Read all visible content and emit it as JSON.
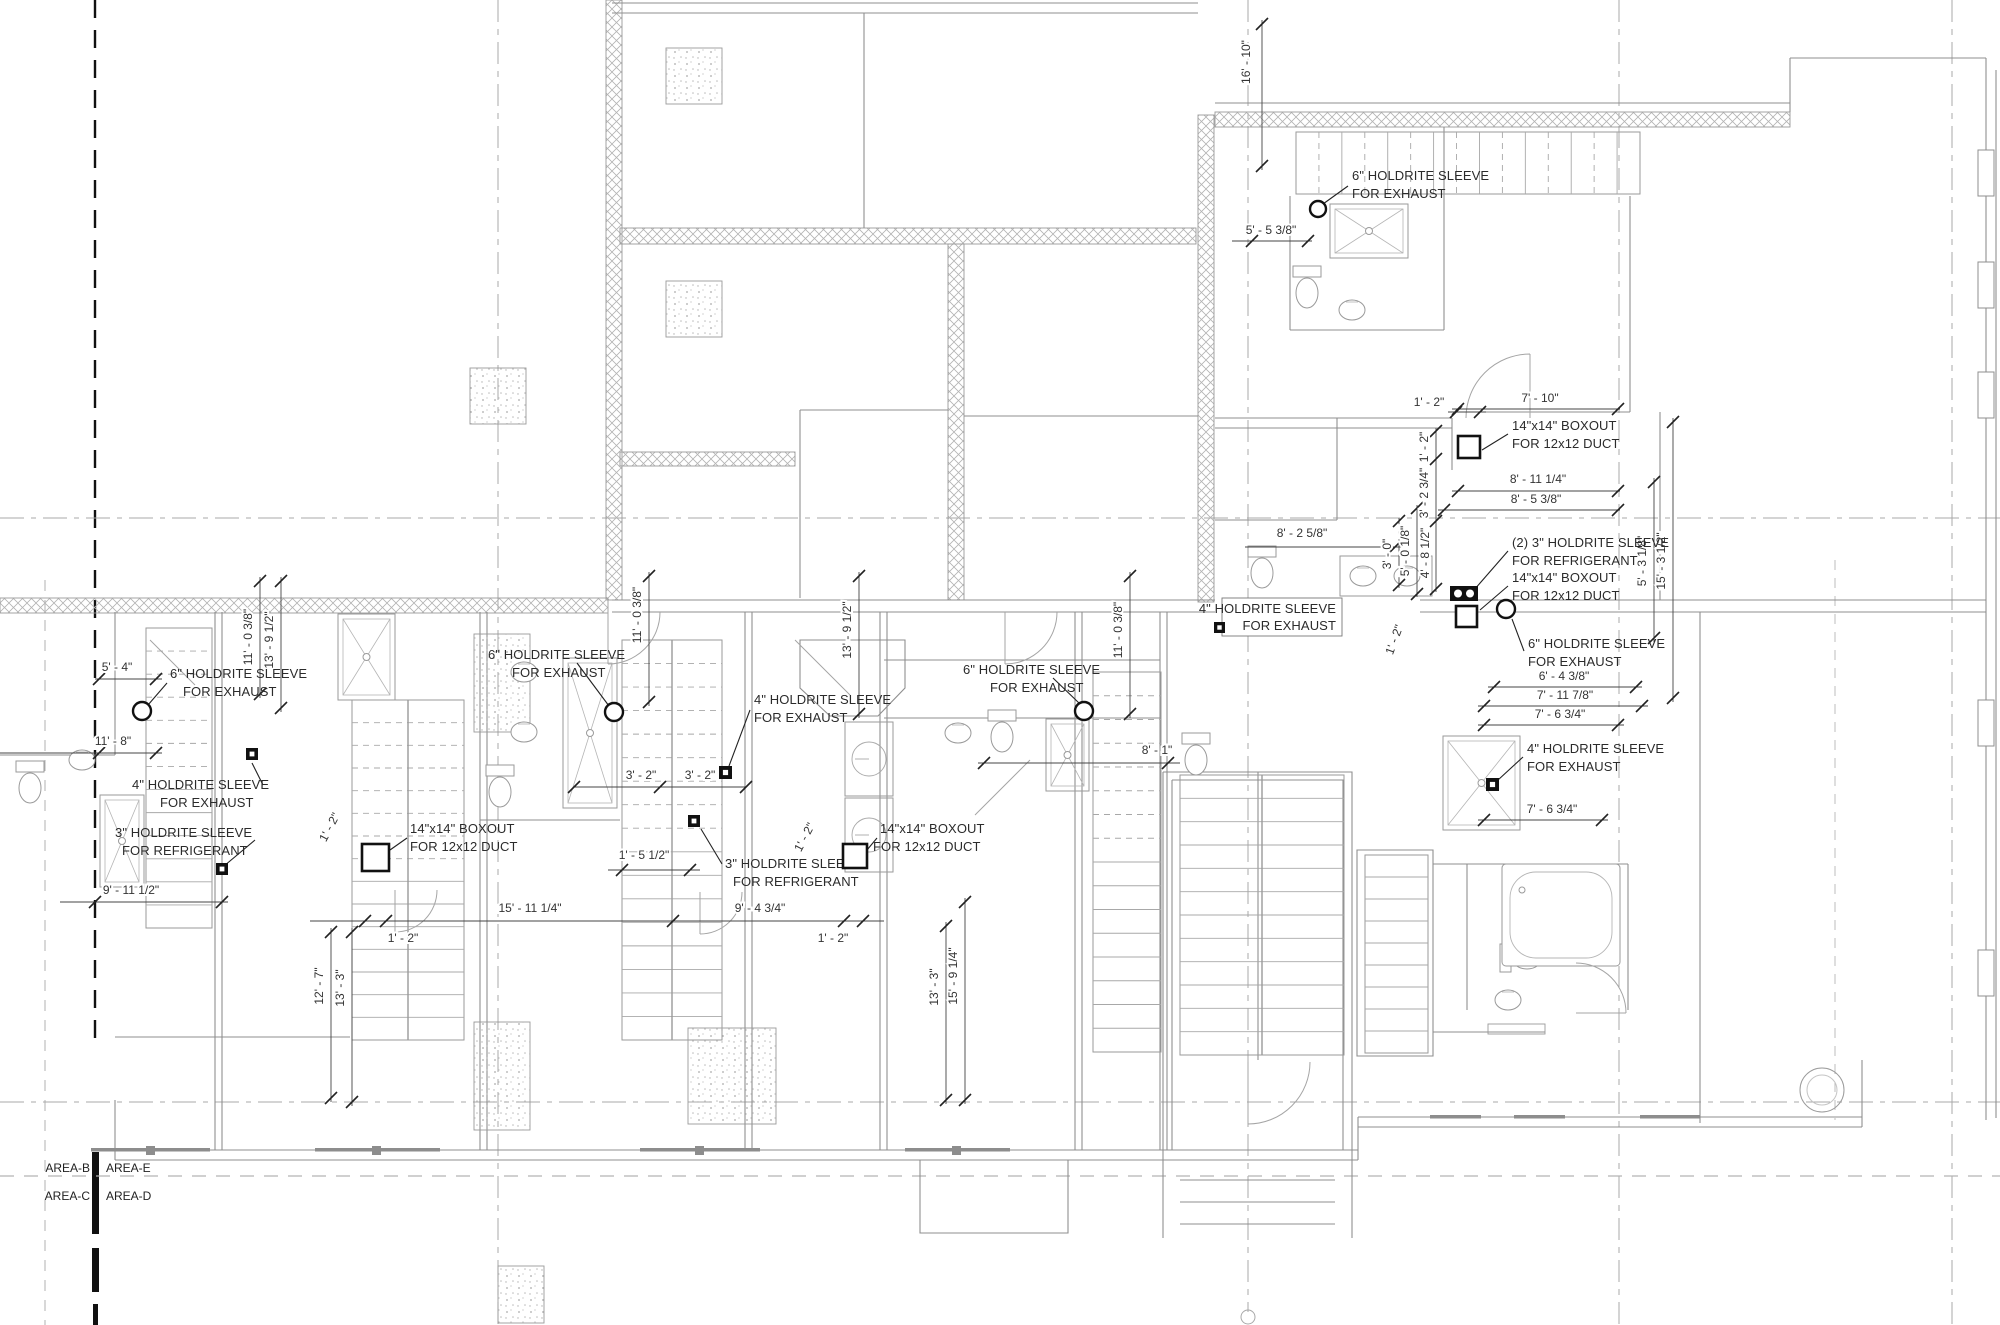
{
  "drawing": {
    "type": "architectural floor plan - mechanical sleeve and boxout plan",
    "area_labels": {
      "b": "AREA-B",
      "e": "AREA-E",
      "c": "AREA-C",
      "d": "AREA-D"
    }
  },
  "colors": {
    "wall": "#8f8f8f",
    "light_wall": "#b5b5b5",
    "annotation": "#1e1e1e",
    "dim": "#333333",
    "grid": "#9e9e9e",
    "heavy_grid": "#111111",
    "hatch": "#b3b3b3"
  },
  "callouts": [
    {
      "lines": [
        "6\" HOLDRITE SLEEVE",
        "FOR EXHAUST"
      ],
      "tx": [
        [
          1352,
          180
        ],
        [
          1352,
          198
        ]
      ],
      "anchor": "start",
      "leader": [
        1348,
        186,
        1323,
        204
      ],
      "node": {
        "type": "circle",
        "x": 1318,
        "y": 209,
        "r": 8
      }
    },
    {
      "lines": [
        "14\"x14\" BOXOUT",
        "FOR 12x12 DUCT"
      ],
      "tx": [
        [
          1512,
          430
        ],
        [
          1512,
          448
        ]
      ],
      "anchor": "start",
      "leader": [
        1508,
        434,
        1482,
        450
      ],
      "node": {
        "type": "duct",
        "x": 1458,
        "y": 436,
        "s": 22
      }
    },
    {
      "lines": [
        "(2) 3\" HOLDRITE SLEEVE",
        "FOR REFRIGERANT"
      ],
      "tx": [
        [
          1512,
          547
        ],
        [
          1512,
          565
        ]
      ],
      "anchor": "start",
      "leader": [
        1508,
        551,
        1474,
        590
      ],
      "node": {
        "type": "duct2",
        "x": 1450,
        "y": 586,
        "s": 28
      }
    },
    {
      "lines": [
        "14\"x14\" BOXOUT",
        "FOR 12x12 DUCT"
      ],
      "tx": [
        [
          1512,
          582
        ],
        [
          1512,
          600
        ]
      ],
      "anchor": "start",
      "leader": [
        1508,
        586,
        1480,
        610
      ],
      "node": {
        "type": "duct",
        "x": 1456,
        "y": 606,
        "s": 21
      }
    },
    {
      "lines": [
        "6\" HOLDRITE SLEEVE",
        "FOR EXHAUST"
      ],
      "tx": [
        [
          1528,
          648
        ],
        [
          1528,
          666
        ]
      ],
      "anchor": "start",
      "leader": [
        1524,
        651,
        1512,
        619
      ],
      "node": {
        "type": "circle",
        "x": 1506,
        "y": 609,
        "r": 9
      }
    },
    {
      "lines": [
        "4\" HOLDRITE  SLEEVE",
        "FOR EXHAUST"
      ],
      "tx": [
        [
          1336,
          613
        ],
        [
          1336,
          630
        ]
      ],
      "anchor": "end",
      "boxed": [
        1222,
        598,
        120,
        38
      ],
      "node": {
        "type": "sqr",
        "x": 1214,
        "y": 622,
        "s": 11
      }
    },
    {
      "lines": [
        "4\" HOLDRITE  SLEEVE",
        "FOR EXHAUST"
      ],
      "tx": [
        [
          1527,
          753
        ],
        [
          1527,
          771
        ]
      ],
      "anchor": "start",
      "leader": [
        1523,
        757,
        1498,
        780
      ],
      "node": {
        "type": "sqr",
        "x": 1486,
        "y": 778,
        "s": 13
      }
    },
    {
      "lines": [
        "6\" HOLDRITE SLEEVE",
        "FOR EXHAUST"
      ],
      "tx": [
        [
          963,
          674
        ],
        [
          990,
          692
        ]
      ],
      "anchor": "start",
      "leader": [
        1053,
        678,
        1080,
        704
      ],
      "node": {
        "type": "circle",
        "x": 1084,
        "y": 711,
        "r": 9
      }
    },
    {
      "lines": [
        "6\" HOLDRITE SLEEVE",
        "FOR EXHAUST"
      ],
      "tx": [
        [
          170,
          678
        ],
        [
          183,
          696
        ]
      ],
      "anchor": "start",
      "leader": [
        167,
        683,
        148,
        705
      ],
      "node": {
        "type": "circle",
        "x": 142,
        "y": 711,
        "r": 9
      }
    },
    {
      "lines": [
        "4\" HOLDRITE  SLEEVE",
        "FOR EXHAUST"
      ],
      "tx": [
        [
          132,
          789
        ],
        [
          160,
          807
        ]
      ],
      "anchor": "start",
      "leader": [
        263,
        785,
        252,
        763
      ],
      "node": {
        "type": "sqr",
        "x": 246,
        "y": 748,
        "s": 12
      }
    },
    {
      "lines": [
        "3\" HOLDRITE SLEEVE",
        "FOR REFRIGERANT"
      ],
      "tx": [
        [
          115,
          837
        ],
        [
          122,
          855
        ]
      ],
      "anchor": "start",
      "leader": [
        255,
        840,
        224,
        866
      ],
      "node": {
        "type": "sqr",
        "x": 216,
        "y": 863,
        "s": 12
      }
    },
    {
      "lines": [
        "14\"x14\" BOXOUT",
        "FOR 12x12 DUCT"
      ],
      "tx": [
        [
          410,
          833
        ],
        [
          410,
          851
        ]
      ],
      "anchor": "start",
      "leader": [
        407,
        838,
        390,
        850
      ],
      "node": {
        "type": "duct",
        "x": 362,
        "y": 844,
        "s": 27
      }
    },
    {
      "lines": [
        "6\" HOLDRITE SLEEVE",
        "FOR EXHAUST"
      ],
      "tx": [
        [
          488,
          659
        ],
        [
          512,
          677
        ]
      ],
      "anchor": "start",
      "leader": [
        577,
        663,
        609,
        706
      ],
      "node": {
        "type": "circle",
        "x": 614,
        "y": 712,
        "r": 9
      }
    },
    {
      "lines": [
        "4\" HOLDRITE  SLEEVE",
        "FOR EXHAUST"
      ],
      "tx": [
        [
          754,
          704
        ],
        [
          754,
          722
        ]
      ],
      "anchor": "start",
      "leader": [
        750,
        710,
        729,
        766
      ],
      "node": {
        "type": "sqr",
        "x": 719,
        "y": 766,
        "s": 13
      }
    },
    {
      "lines": [
        "3\" HOLDRITE SLEEVE",
        "FOR REFRIGERANT"
      ],
      "tx": [
        [
          725,
          868
        ],
        [
          733,
          886
        ]
      ],
      "anchor": "start",
      "leader": [
        722,
        864,
        701,
        829
      ],
      "node": {
        "type": "sqr",
        "x": 688,
        "y": 815,
        "s": 12
      }
    },
    {
      "lines": [
        "14\"x14\" BOXOUT",
        "FOR 12x12 DUCT"
      ],
      "tx": [
        [
          880,
          833
        ],
        [
          873,
          851
        ]
      ],
      "anchor": "start",
      "leader": [
        877,
        838,
        867,
        850
      ],
      "node": {
        "type": "duct",
        "x": 843,
        "y": 844,
        "s": 24
      }
    }
  ],
  "dim_labels": [
    {
      "text": "16' - 10\"",
      "x": 1250,
      "y": 62,
      "rot": -90
    },
    {
      "text": "5' - 5 3/8\"",
      "x": 1271,
      "y": 234,
      "rot": 0
    },
    {
      "text": "7' - 10\"",
      "x": 1540,
      "y": 402,
      "rot": 0
    },
    {
      "text": "1' - 2\"",
      "x": 1429,
      "y": 406,
      "rot": 0
    },
    {
      "text": "8' - 11 1/4\"",
      "x": 1538,
      "y": 483,
      "rot": 0
    },
    {
      "text": "8' - 5 3/8\"",
      "x": 1536,
      "y": 503,
      "rot": 0
    },
    {
      "text": "8' - 2 5/8\"",
      "x": 1302,
      "y": 537,
      "rot": 0
    },
    {
      "text": "1' - 2\"",
      "x": 1428,
      "y": 447,
      "rot": -90
    },
    {
      "text": "3' - 2 3/4\"",
      "x": 1428,
      "y": 493,
      "rot": -90
    },
    {
      "text": "4' - 8 1/2\"",
      "x": 1429,
      "y": 553,
      "rot": -90
    },
    {
      "text": "5' - 0 1/8\"",
      "x": 1409,
      "y": 551,
      "rot": -90
    },
    {
      "text": "3' - 0\"",
      "x": 1391,
      "y": 554,
      "rot": -90
    },
    {
      "text": "5' - 3 1/8\"",
      "x": 1646,
      "y": 561,
      "rot": -90
    },
    {
      "text": "15' - 3 1/2\"",
      "x": 1665,
      "y": 561,
      "rot": -90
    },
    {
      "text": "6' - 4 3/8\"",
      "x": 1564,
      "y": 680,
      "rot": 0
    },
    {
      "text": "7' - 11 7/8\"",
      "x": 1565,
      "y": 699,
      "rot": 0
    },
    {
      "text": "7' - 6 3/4\"",
      "x": 1560,
      "y": 718,
      "rot": 0
    },
    {
      "text": "7' - 6 3/4\"",
      "x": 1552,
      "y": 813,
      "rot": 0
    },
    {
      "text": "8' - 1\"",
      "x": 1157,
      "y": 754,
      "rot": 0
    },
    {
      "text": "5' - 4\"",
      "x": 117,
      "y": 671,
      "rot": 0
    },
    {
      "text": "11' - 8\"",
      "x": 113,
      "y": 745,
      "rot": 0
    },
    {
      "text": "9' - 11 1/2\"",
      "x": 131,
      "y": 894,
      "rot": 0
    },
    {
      "text": "3' - 2\"",
      "x": 641,
      "y": 779,
      "rot": 0
    },
    {
      "text": "3' - 2\"",
      "x": 700,
      "y": 779,
      "rot": 0
    },
    {
      "text": "1' - 5 1/2\"",
      "x": 644,
      "y": 859,
      "rot": 0
    },
    {
      "text": "15' - 11 1/4\"",
      "x": 530,
      "y": 912,
      "rot": 0
    },
    {
      "text": "9' - 4 3/4\"",
      "x": 760,
      "y": 912,
      "rot": 0
    },
    {
      "text": "1' - 2\"",
      "x": 403,
      "y": 942,
      "rot": 0
    },
    {
      "text": "1' - 2\"",
      "x": 833,
      "y": 942,
      "rot": 0
    },
    {
      "text": "12' - 7\"",
      "x": 323,
      "y": 986,
      "rot": -90
    },
    {
      "text": "13' - 3\"",
      "x": 344,
      "y": 988,
      "rot": -90
    },
    {
      "text": "13' - 3\"",
      "x": 938,
      "y": 987,
      "rot": -90
    },
    {
      "text": "15' - 9 1/4\"",
      "x": 957,
      "y": 976,
      "rot": -90
    },
    {
      "text": "11' - 0 3/8\"",
      "x": 252,
      "y": 637,
      "rot": -90
    },
    {
      "text": "13' - 9 1/2\"",
      "x": 273,
      "y": 640,
      "rot": -90
    },
    {
      "text": "11' - 0 3/8\"",
      "x": 641,
      "y": 615,
      "rot": -90
    },
    {
      "text": "13' - 9 1/2\"",
      "x": 851,
      "y": 630,
      "rot": -90
    },
    {
      "text": "11' - 0 3/8\"",
      "x": 1122,
      "y": 630,
      "rot": -90
    },
    {
      "text": "1' - 2\"",
      "x": 333,
      "y": 829,
      "rot": -62
    },
    {
      "text": "1' - 2\"",
      "x": 808,
      "y": 839,
      "rot": -62
    },
    {
      "text": "1' - 2\"",
      "x": 1398,
      "y": 641,
      "rot": -70
    }
  ],
  "dim_lines": [
    {
      "x1": 1262,
      "y1": 20,
      "x2": 1262,
      "y2": 170,
      "ticks": [
        [
          1262,
          24
        ],
        [
          1262,
          166
        ]
      ]
    },
    {
      "x1": 1232,
      "y1": 241,
      "x2": 1312,
      "y2": 241,
      "ticks": [
        [
          1252,
          241
        ],
        [
          1308,
          241
        ]
      ]
    },
    {
      "x1": 1452,
      "y1": 409,
      "x2": 1620,
      "y2": 409,
      "ticks": [
        [
          1458,
          409
        ],
        [
          1618,
          409
        ]
      ]
    },
    {
      "x1": 1448,
      "y1": 412,
      "x2": 1486,
      "y2": 412,
      "ticks": [
        [
          1456,
          412
        ],
        [
          1480,
          412
        ]
      ]
    },
    {
      "x1": 1452,
      "y1": 491,
      "x2": 1620,
      "y2": 491,
      "ticks": [
        [
          1458,
          491
        ],
        [
          1618,
          491
        ]
      ]
    },
    {
      "x1": 1438,
      "y1": 510,
      "x2": 1620,
      "y2": 510,
      "ticks": [
        [
          1444,
          510
        ],
        [
          1618,
          510
        ]
      ]
    },
    {
      "x1": 1245,
      "y1": 547,
      "x2": 1402,
      "y2": 547,
      "ticks": [
        [
          1395,
          547
        ]
      ]
    },
    {
      "x1": 1436,
      "y1": 428,
      "x2": 1436,
      "y2": 592,
      "ticks": [
        [
          1436,
          431
        ],
        [
          1436,
          459
        ],
        [
          1436,
          521
        ],
        [
          1436,
          589
        ]
      ]
    },
    {
      "x1": 1417,
      "y1": 505,
      "x2": 1417,
      "y2": 597,
      "ticks": [
        [
          1417,
          508
        ],
        [
          1417,
          594
        ]
      ]
    },
    {
      "x1": 1399,
      "y1": 518,
      "x2": 1399,
      "y2": 588,
      "ticks": [
        [
          1399,
          521
        ],
        [
          1399,
          585
        ]
      ]
    },
    {
      "x1": 1654,
      "y1": 478,
      "x2": 1654,
      "y2": 642,
      "ticks": [
        [
          1654,
          482
        ],
        [
          1654,
          638
        ]
      ]
    },
    {
      "x1": 1673,
      "y1": 418,
      "x2": 1673,
      "y2": 702,
      "ticks": [
        [
          1673,
          422
        ],
        [
          1673,
          698
        ]
      ]
    },
    {
      "x1": 1488,
      "y1": 687,
      "x2": 1642,
      "y2": 687,
      "ticks": [
        [
          1494,
          687
        ],
        [
          1636,
          687
        ]
      ]
    },
    {
      "x1": 1478,
      "y1": 706,
      "x2": 1648,
      "y2": 706,
      "ticks": [
        [
          1484,
          706
        ],
        [
          1642,
          706
        ]
      ]
    },
    {
      "x1": 1478,
      "y1": 725,
      "x2": 1624,
      "y2": 725,
      "ticks": [
        [
          1484,
          725
        ],
        [
          1618,
          725
        ]
      ]
    },
    {
      "x1": 1478,
      "y1": 820,
      "x2": 1608,
      "y2": 820,
      "ticks": [
        [
          1484,
          820
        ],
        [
          1602,
          820
        ]
      ]
    },
    {
      "x1": 978,
      "y1": 763,
      "x2": 1180,
      "y2": 763,
      "ticks": [
        [
          984,
          763
        ],
        [
          1168,
          763
        ]
      ]
    },
    {
      "x1": 95,
      "y1": 679,
      "x2": 162,
      "y2": 679,
      "ticks": [
        [
          99,
          679
        ],
        [
          156,
          679
        ]
      ]
    },
    {
      "x1": 0,
      "y1": 753,
      "x2": 162,
      "y2": 753,
      "ticks": [
        [
          99,
          753
        ],
        [
          156,
          753
        ]
      ]
    },
    {
      "x1": 60,
      "y1": 902,
      "x2": 228,
      "y2": 902,
      "ticks": [
        [
          95,
          902
        ],
        [
          222,
          902
        ]
      ]
    },
    {
      "x1": 574,
      "y1": 787,
      "x2": 746,
      "y2": 787,
      "ticks": [
        [
          574,
          787
        ],
        [
          660,
          787
        ],
        [
          746,
          787
        ]
      ]
    },
    {
      "x1": 608,
      "y1": 870,
      "x2": 700,
      "y2": 870,
      "ticks": [
        [
          622,
          870
        ],
        [
          690,
          870
        ]
      ]
    },
    {
      "x1": 310,
      "y1": 921,
      "x2": 884,
      "y2": 921,
      "ticks": [
        [
          365,
          921
        ],
        [
          386,
          921
        ],
        [
          673,
          921
        ],
        [
          844,
          921
        ],
        [
          863,
          921
        ]
      ]
    },
    {
      "x1": 331,
      "y1": 928,
      "x2": 331,
      "y2": 1102,
      "ticks": [
        [
          331,
          932
        ],
        [
          331,
          1098
        ]
      ]
    },
    {
      "x1": 352,
      "y1": 928,
      "x2": 352,
      "y2": 1106,
      "ticks": [
        [
          352,
          932
        ],
        [
          352,
          1102
        ]
      ]
    },
    {
      "x1": 946,
      "y1": 922,
      "x2": 946,
      "y2": 1104,
      "ticks": [
        [
          946,
          926
        ],
        [
          946,
          1100
        ]
      ]
    },
    {
      "x1": 965,
      "y1": 898,
      "x2": 965,
      "y2": 1104,
      "ticks": [
        [
          965,
          902
        ],
        [
          965,
          1100
        ]
      ]
    },
    {
      "x1": 260,
      "y1": 577,
      "x2": 260,
      "y2": 698,
      "ticks": [
        [
          260,
          581
        ],
        [
          260,
          694
        ]
      ]
    },
    {
      "x1": 281,
      "y1": 577,
      "x2": 281,
      "y2": 712,
      "ticks": [
        [
          281,
          581
        ],
        [
          281,
          708
        ]
      ]
    },
    {
      "x1": 649,
      "y1": 572,
      "x2": 649,
      "y2": 706,
      "ticks": [
        [
          649,
          576
        ],
        [
          649,
          702
        ]
      ]
    },
    {
      "x1": 859,
      "y1": 572,
      "x2": 859,
      "y2": 718,
      "ticks": [
        [
          859,
          576
        ],
        [
          859,
          714
        ]
      ]
    },
    {
      "x1": 1130,
      "y1": 572,
      "x2": 1130,
      "y2": 718,
      "ticks": [
        [
          1130,
          576
        ],
        [
          1130,
          714
        ]
      ]
    }
  ]
}
